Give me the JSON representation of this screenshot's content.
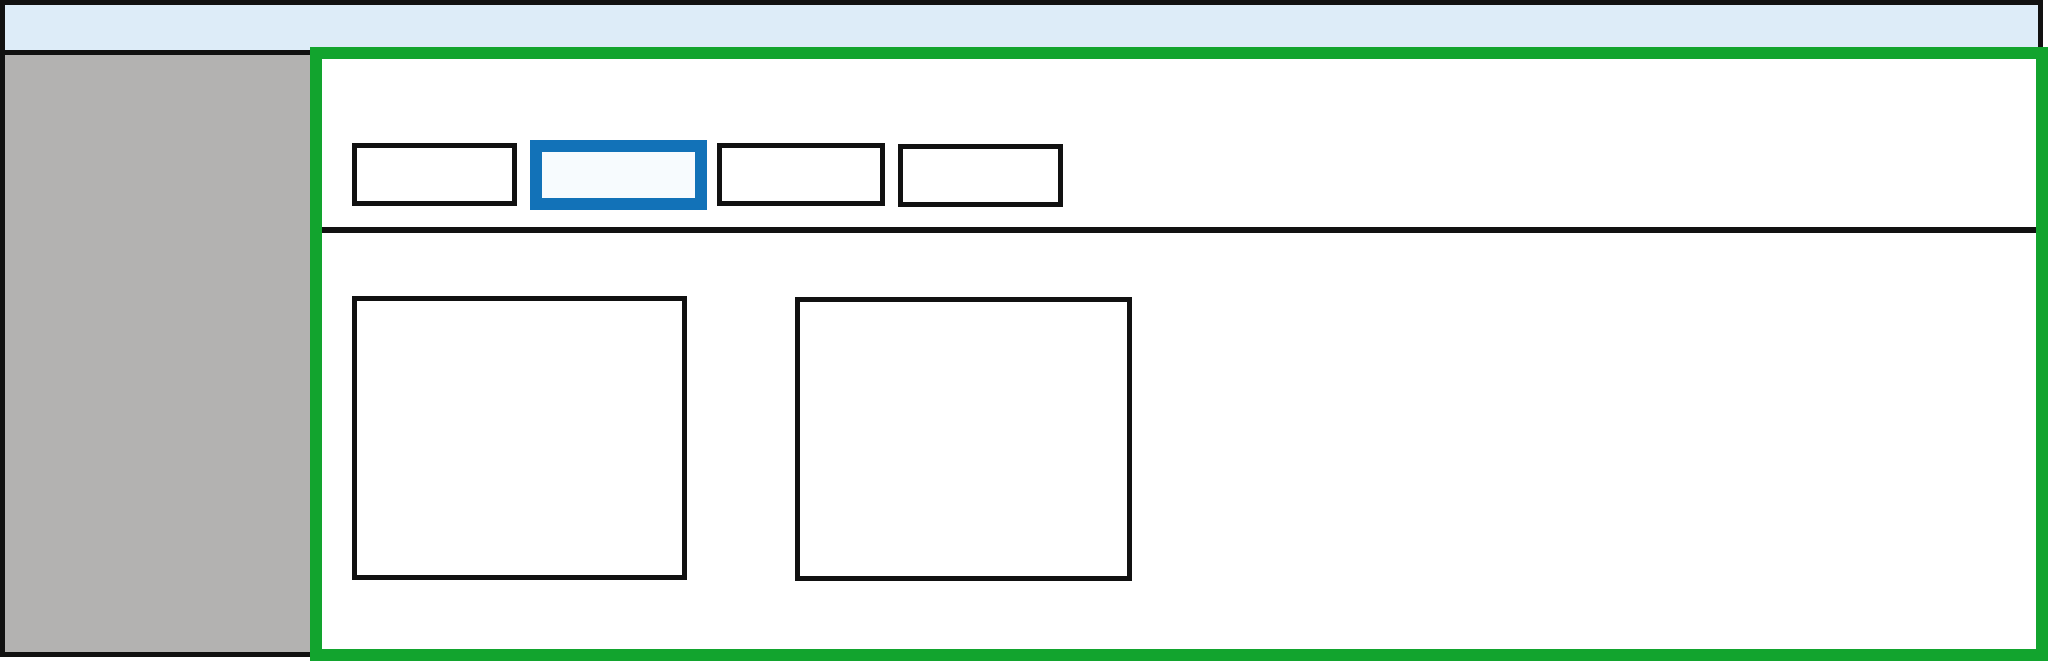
{
  "window": {
    "titlebar": {
      "fill": "#ddecf8"
    },
    "sidebar": {
      "fill": "#b3b2b1",
      "items": []
    },
    "main_panel": {
      "highlight_outline": "#12a42e",
      "tabs": [
        {
          "name": "tab-1",
          "active": false
        },
        {
          "name": "tab-2",
          "active": true
        },
        {
          "name": "tab-3",
          "active": false
        },
        {
          "name": "tab-4",
          "active": false
        }
      ],
      "active_tab_index": 1,
      "content_cards": 2
    }
  },
  "colors": {
    "background": "#ffffff",
    "titlebar_fill": "#ddecf8",
    "sidebar_fill": "#b3b2b1",
    "outline_black": "#111111",
    "highlight_green": "#12a42e",
    "active_tab_blue": "#1272b8",
    "active_tab_fill": "#f7fbfe"
  }
}
